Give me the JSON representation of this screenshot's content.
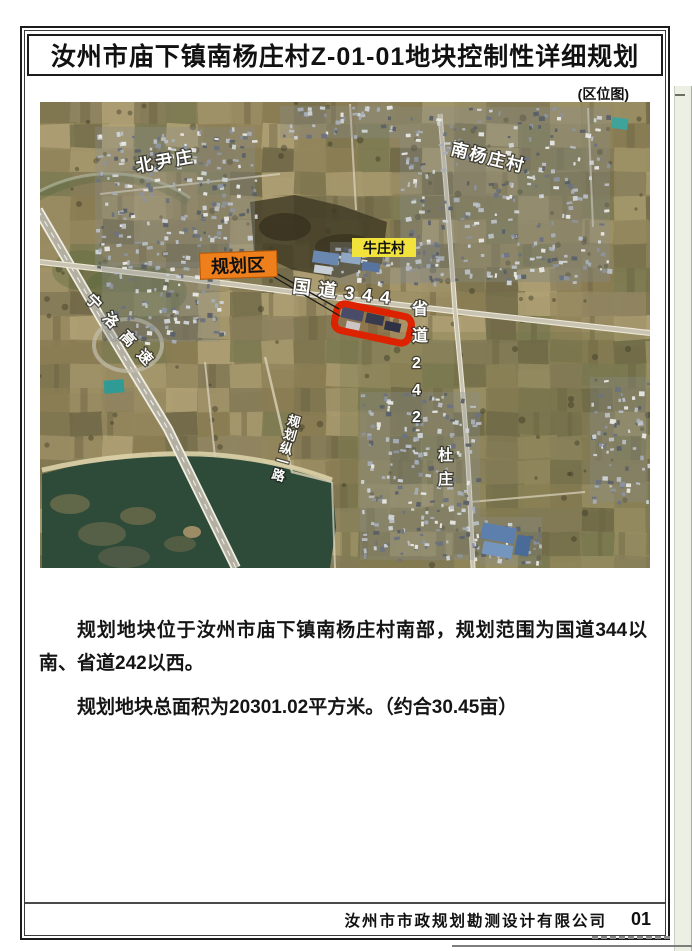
{
  "page": {
    "title": "汝州市庙下镇南杨庄村Z-01-01地块控制性详细规划",
    "map_caption": "(区位图)",
    "paragraphs": {
      "p1": "规划地块位于汝州市庙下镇南杨庄村南部，规划范围为国道344以南、省道242以西。",
      "p2": "规划地块总面积为20301.02平方米。（约合30.45亩）"
    },
    "footer": {
      "company": "汝州市市政规划勘测设计有限公司",
      "page_number": "01"
    }
  },
  "map": {
    "labels": {
      "planning_area": "规划区",
      "beiyinzhuang": "北尹庄",
      "nanyangzhuang": "南杨庄村",
      "niuzhuang": "牛庄村",
      "duzhuang": "杜庄",
      "g344": "国道344",
      "s242": "省道242",
      "ninluo_expressway": "宁洛高速",
      "planned_road": "规划纵一路"
    },
    "colors": {
      "parcel_outline": "#dd2200",
      "planning_area_label_bg": "#ef7f1a",
      "niuzhuang_label_bg": "#f2e23c",
      "water": "#2e4a38"
    }
  }
}
